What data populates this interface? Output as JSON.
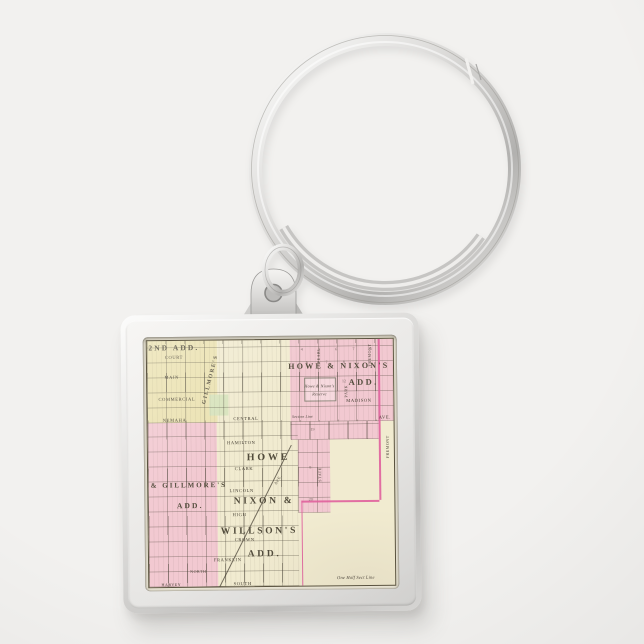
{
  "colors": {
    "background": "#f2f1ef",
    "metal_light": "#fbfbfa",
    "metal_mid": "#d6d5d3",
    "metal_dark": "#a9a8a6",
    "map_cream": "#f1ebd0",
    "map_yellow": "#ebe2b2",
    "map_pink": "#f2c9d1",
    "map_green": "#d8e3bd",
    "magenta": "#e0609c",
    "label_ink": "#433e32"
  },
  "map": {
    "labels": [
      {
        "t": "2ND ADD.",
        "x": 11,
        "y": 3,
        "fs": 7.5,
        "s": "big"
      },
      {
        "t": "HOWE & NIXON'S",
        "x": 78,
        "y": 11,
        "fs": 8,
        "s": "big"
      },
      {
        "t": "ADD.",
        "x": 88,
        "y": 17.5,
        "fs": 8.5,
        "s": "big"
      },
      {
        "t": "ED & GILLMORE'S",
        "x": 13,
        "y": 59,
        "fs": 7,
        "s": "big"
      },
      {
        "t": "ADD.",
        "x": 17,
        "y": 67,
        "fs": 7.5,
        "s": "big"
      },
      {
        "t": "HOWE",
        "x": 49,
        "y": 48,
        "fs": 10,
        "s": "big"
      },
      {
        "t": "NIXON &",
        "x": 47,
        "y": 66,
        "fs": 9.5,
        "s": "big"
      },
      {
        "t": "WILLSON'S",
        "x": 45,
        "y": 78,
        "fs": 9.5,
        "s": "big"
      },
      {
        "t": "ADD.",
        "x": 47,
        "y": 87.5,
        "fs": 9.5,
        "s": "big"
      },
      {
        "t": "GILLMORE'S",
        "x": 26,
        "y": 16,
        "fs": 5.5,
        "s": "big",
        "rot": -75
      },
      {
        "t": "COURT",
        "x": 11,
        "y": 7,
        "fs": 4.5,
        "s": "street"
      },
      {
        "t": "MAIN",
        "x": 10,
        "y": 15,
        "fs": 4.5,
        "s": "street"
      },
      {
        "t": "COMMERCIAL",
        "x": 12,
        "y": 24,
        "fs": 4.5,
        "s": "street"
      },
      {
        "t": "NEMAHA",
        "x": 11,
        "y": 32.5,
        "fs": 4.5,
        "s": "street"
      },
      {
        "t": "CENTRAL",
        "x": 40,
        "y": 32,
        "fs": 4.5,
        "s": "street"
      },
      {
        "t": "HAMILTON",
        "x": 38,
        "y": 42,
        "fs": 4.5,
        "s": "street"
      },
      {
        "t": "CLARK",
        "x": 39,
        "y": 52.5,
        "fs": 4.5,
        "s": "street"
      },
      {
        "t": "LINCOLN",
        "x": 38,
        "y": 61.5,
        "fs": 4.5,
        "s": "street"
      },
      {
        "t": "HIGH",
        "x": 37,
        "y": 71,
        "fs": 4.5,
        "s": "street"
      },
      {
        "t": "CROWN",
        "x": 39,
        "y": 81.5,
        "fs": 4.5,
        "s": "street"
      },
      {
        "t": "FRANKLIN",
        "x": 32,
        "y": 89.5,
        "fs": 4.5,
        "s": "street"
      },
      {
        "t": "NORTH",
        "x": 20,
        "y": 94,
        "fs": 4,
        "s": "street"
      },
      {
        "t": "SOUTH",
        "x": 38,
        "y": 99,
        "fs": 4.5,
        "s": "street"
      },
      {
        "t": "HARVEY",
        "x": 9,
        "y": 99,
        "fs": 4,
        "s": "street"
      },
      {
        "t": "MADISON",
        "x": 86,
        "y": 25,
        "fs": 4.5,
        "s": "street"
      },
      {
        "t": "AVE.",
        "x": 96.5,
        "y": 32.3,
        "fs": 4.5,
        "s": "street"
      },
      {
        "t": "PEARL",
        "x": 70,
        "y": 6.5,
        "fs": 4,
        "s": "street",
        "rot": -90
      },
      {
        "t": "PARK",
        "x": 81,
        "y": 21,
        "fs": 4,
        "s": "street",
        "rot": -90
      },
      {
        "t": "FREMONT",
        "x": 90.5,
        "y": 6.5,
        "fs": 4,
        "s": "street",
        "rot": -90
      },
      {
        "t": "FREMONT",
        "x": 97.5,
        "y": 44,
        "fs": 4,
        "s": "street",
        "rot": -90
      },
      {
        "t": "STATE",
        "x": 70,
        "y": 55,
        "fs": 4,
        "s": "street",
        "rot": -90
      },
      {
        "t": "AVE.",
        "x": 53,
        "y": 57,
        "fs": 4,
        "s": "street",
        "rot": -58
      },
      {
        "t": "Howe & Nixon's",
        "x": 70,
        "y": 19,
        "fs": 4.2,
        "s": "italic"
      },
      {
        "t": "Reserve",
        "x": 70,
        "y": 22.5,
        "fs": 4.2,
        "s": "italic"
      },
      {
        "t": "Section Line",
        "x": 63,
        "y": 31.8,
        "fs": 3.8,
        "s": "italic"
      },
      {
        "t": "One Half Sect Line",
        "x": 84,
        "y": 97,
        "fs": 4.5,
        "s": "italic"
      },
      {
        "t": "4",
        "x": 63,
        "y": 4,
        "fs": 4,
        "s": "num"
      },
      {
        "t": "5",
        "x": 70,
        "y": 4,
        "fs": 4,
        "s": "num"
      },
      {
        "t": "6",
        "x": 77,
        "y": 4,
        "fs": 4,
        "s": "num"
      },
      {
        "t": "7",
        "x": 84,
        "y": 4,
        "fs": 4,
        "s": "num"
      },
      {
        "t": "8",
        "x": 91,
        "y": 4,
        "fs": 4,
        "s": "num"
      },
      {
        "t": "6",
        "x": 65,
        "y": 9.5,
        "fs": 4,
        "s": "num"
      },
      {
        "t": "7",
        "x": 73,
        "y": 9.5,
        "fs": 4,
        "s": "num"
      },
      {
        "t": "8",
        "x": 80,
        "y": 9.5,
        "fs": 4,
        "s": "num"
      },
      {
        "t": "12",
        "x": 80,
        "y": 17,
        "fs": 4,
        "s": "num"
      },
      {
        "t": "19",
        "x": 67,
        "y": 36.5,
        "fs": 4,
        "s": "num"
      },
      {
        "t": "8",
        "x": 66,
        "y": 52,
        "fs": 4,
        "s": "num"
      },
      {
        "t": "20",
        "x": 66,
        "y": 65,
        "fs": 4,
        "s": "num"
      }
    ]
  }
}
